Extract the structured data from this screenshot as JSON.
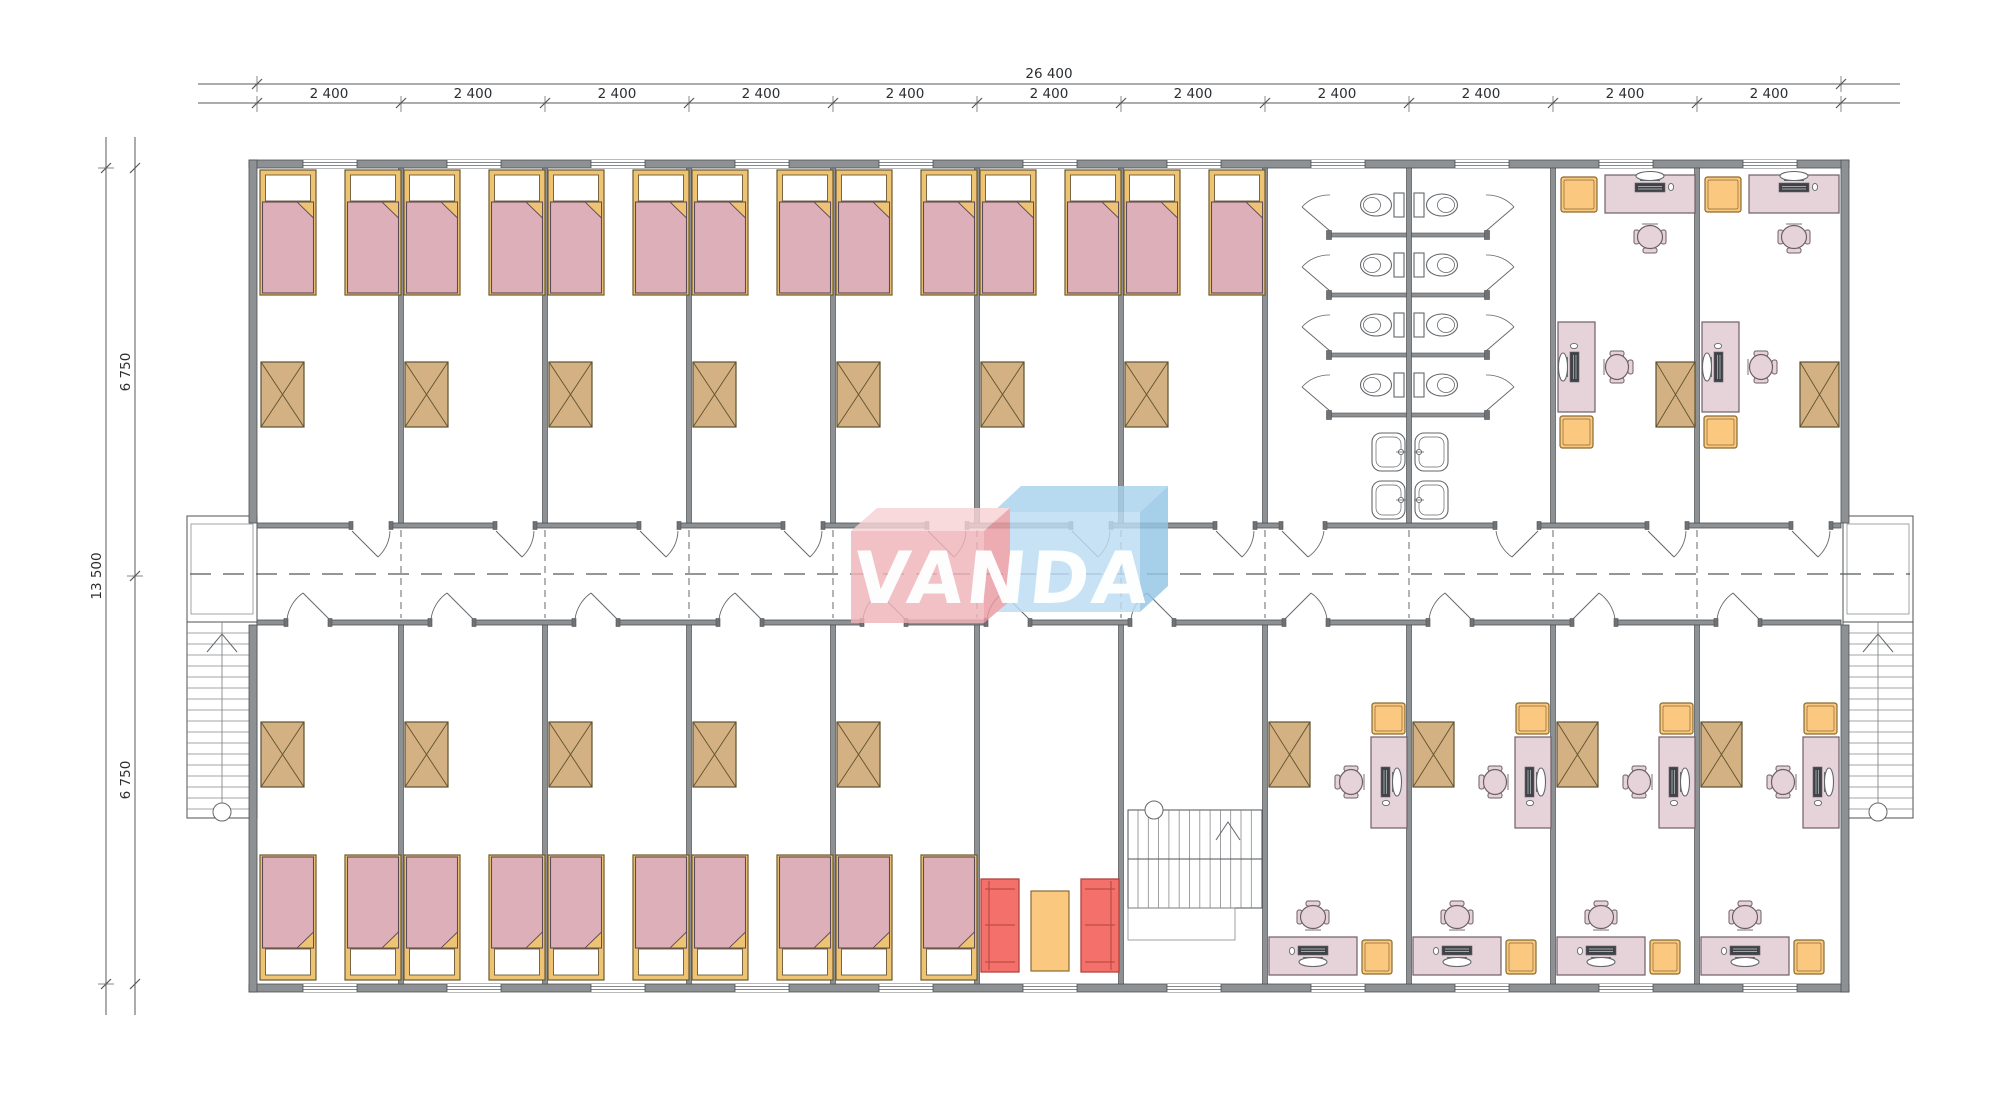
{
  "dimensions": {
    "total_width": "26 400",
    "module_width": "2 400",
    "module_count": 11,
    "total_height": "13 500",
    "half_height": "6 750"
  },
  "logo": {
    "text": "VANDA",
    "pink": "#f0b4b9",
    "pink_light": "#f7d3d6",
    "pink_dark": "#e99aa1",
    "blue": "#bddcf4",
    "blue_light": "#a9d2ee",
    "blue_dark": "#93c6e6"
  },
  "colors": {
    "wall": "#8e9194",
    "wall_dark": "#4e5154",
    "fixture": "#63666a",
    "bed_frame": "#efc374",
    "bed_frame_line": "#6b5a33",
    "pillow": "#ffffff",
    "blanket": "#ddafb8",
    "blanket_line": "#5f4a55",
    "wardrobe": "#d3b183",
    "wardrobe_line": "#5f5130",
    "desk": "#e6d3da",
    "desk_line": "#6e5f66",
    "cabinet": "#fac87e",
    "cabinet_line": "#8a6a33",
    "sofa": "#f3716a",
    "sofa_line": "#b2443e",
    "computer": "#3f4246",
    "dim_line": "#55585b"
  },
  "layout": {
    "top_modules": [
      "bedroom",
      "bedroom",
      "bedroom",
      "bedroom",
      "bedroom",
      "bedroom",
      "bedroom",
      "wc",
      "wc",
      "office",
      "office"
    ],
    "bottom_modules": [
      "bedroom",
      "bedroom",
      "bedroom",
      "bedroom",
      "bedroom",
      "lounge",
      "stairwell",
      "office",
      "office",
      "office",
      "office"
    ]
  },
  "inventory": {
    "beds": 24,
    "wardrobes": 18,
    "desks": 12,
    "office_chairs": 12,
    "cabinets": 12,
    "toilets": 8,
    "sinks": 4,
    "toilet_stalls": 8,
    "sofas": 2,
    "coffee_tables": 1,
    "external_stairs": 2,
    "internal_stairs": 1
  }
}
